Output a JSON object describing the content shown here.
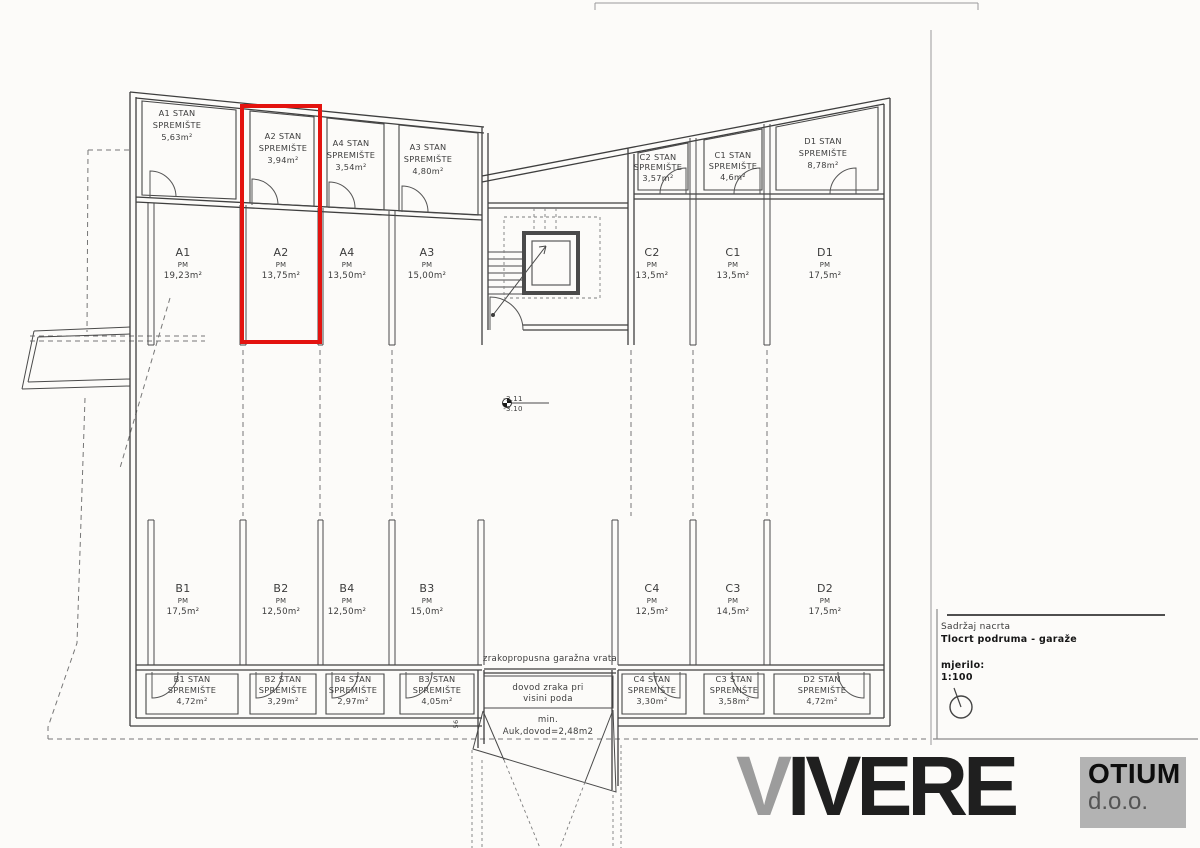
{
  "plan": {
    "storage_top": [
      {
        "name": "A1 STAN",
        "type": "SPREMIŠTE",
        "area": "5,63m²"
      },
      {
        "name": "A2 STAN",
        "type": "SPREMIŠTE",
        "area": "3,94m²"
      },
      {
        "name": "A4 STAN",
        "type": "SPREMIŠTE",
        "area": "3,54m²"
      },
      {
        "name": "A3 STAN",
        "type": "SPREMIŠTE",
        "area": "4,80m²"
      }
    ],
    "storage_right": [
      {
        "name": "C2 STAN",
        "type": "SPREMIŠTE",
        "area": "3,57m²"
      },
      {
        "name": "C1 STAN",
        "type": "SPREMIŠTE",
        "area": "4,6m²"
      },
      {
        "name": "D1 STAN",
        "type": "SPREMIŠTE",
        "area": "8,78m²"
      }
    ],
    "parking_top": [
      {
        "id": "A1",
        "kind": "PM",
        "area": "19,23m²"
      },
      {
        "id": "A2",
        "kind": "PM",
        "area": "13,75m²"
      },
      {
        "id": "A4",
        "kind": "PM",
        "area": "13,50m²"
      },
      {
        "id": "A3",
        "kind": "PM",
        "area": "15,00m²"
      },
      {
        "id": "C2",
        "kind": "PM",
        "area": "13,5m²"
      },
      {
        "id": "C1",
        "kind": "PM",
        "area": "13,5m²"
      },
      {
        "id": "D1",
        "kind": "PM",
        "area": "17,5m²"
      }
    ],
    "parking_bottom": [
      {
        "id": "B1",
        "kind": "PM",
        "area": "17,5m²"
      },
      {
        "id": "B2",
        "kind": "PM",
        "area": "12,50m²"
      },
      {
        "id": "B4",
        "kind": "PM",
        "area": "12,50m²"
      },
      {
        "id": "B3",
        "kind": "PM",
        "area": "15,0m²"
      },
      {
        "id": "C4",
        "kind": "PM",
        "area": "12,5m²"
      },
      {
        "id": "C3",
        "kind": "PM",
        "area": "14,5m²"
      },
      {
        "id": "D2",
        "kind": "PM",
        "area": "17,5m²"
      }
    ],
    "storage_bottom": [
      {
        "name": "B1 STAN",
        "type": "SPREMIŠTE",
        "area": "4,72m²"
      },
      {
        "name": "B2 STAN",
        "type": "SPREMIŠTE",
        "area": "3,29m²"
      },
      {
        "name": "B4 STAN",
        "type": "SPREMIŠTE",
        "area": "2,97m²"
      },
      {
        "name": "B3 STAN",
        "type": "SPREMIŠTE",
        "area": "4,05m²"
      },
      {
        "name": "C4 STAN",
        "type": "SPREMIŠTE",
        "area": "3,30m²"
      },
      {
        "name": "C3 STAN",
        "type": "SPREMIŠTE",
        "area": "3,58m²"
      },
      {
        "name": "D2 STAN",
        "type": "SPREMIŠTE",
        "area": "4,72m²"
      }
    ],
    "annotations": {
      "garage_door": "zrakopropusna garažna vrata",
      "air_line1": "dovod zraka pri",
      "air_line2": "visini poda",
      "min_line1": "min.",
      "min_line2": "Auk,dovod=2,48m2",
      "level_top": "-3.11",
      "level_bottom": "-3.10",
      "dim": "56"
    },
    "highlight_color": "#e3130f"
  },
  "title_block": {
    "content_label": "Sadržaj nacrta",
    "content_value": "Tlocrt podruma - garaže",
    "scale_label": "mjerilo:",
    "scale_value": "1:100"
  },
  "logo": {
    "brand_initial": "V",
    "brand_rest": "IVERE",
    "company": "OTIUM",
    "suffix": "d.o.o."
  }
}
